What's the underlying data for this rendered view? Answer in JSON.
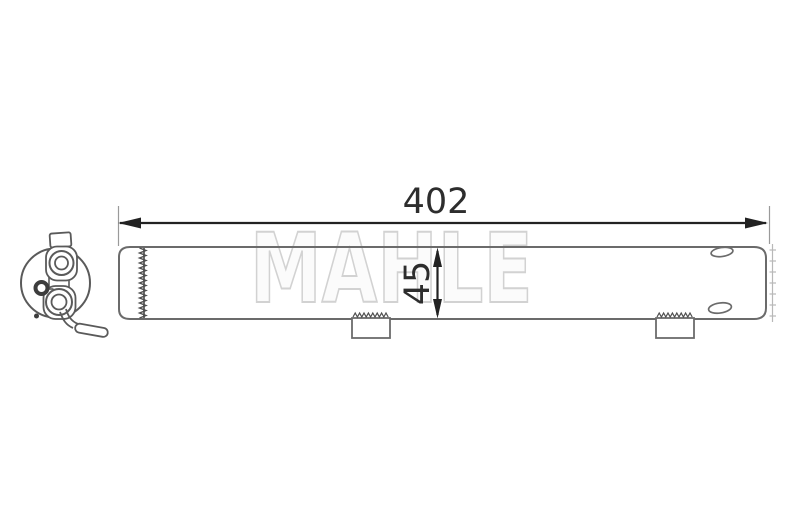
{
  "watermark_text": "MAHLE",
  "dimensions": {
    "length": "402",
    "diameter": "45"
  },
  "colors": {
    "background": "#ffffff",
    "part_outline": "#6b6b6b",
    "end_view_outline": "#5a5a5a",
    "dimension_ink": "#2d2d2d",
    "extension_line": "#9a9a9a",
    "crimp_serration": "#4f4f4f",
    "faint_serration": "#b8b8b8",
    "watermark_outline": "#d2d2d2"
  }
}
